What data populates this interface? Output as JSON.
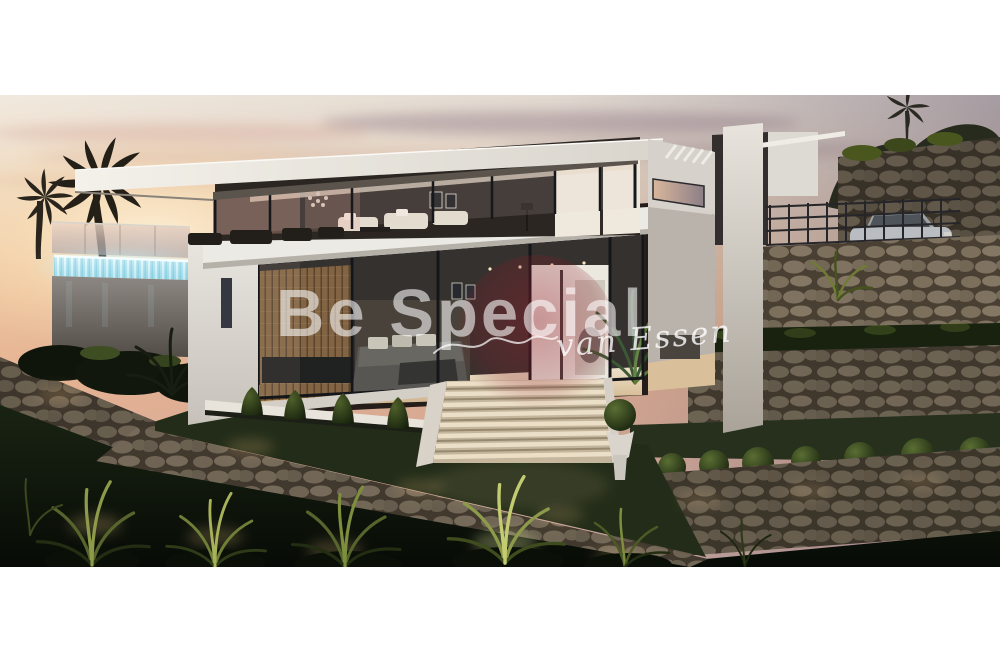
{
  "window": {
    "width": 1000,
    "height": 667,
    "background": "#ffffff"
  },
  "photo": {
    "description": "Architectural render of a modern two-storey white villa at sunset with infinity pool, glowing waterfall edge, glass walls, stone retaining walls, illuminated garden plants and a silver sports car on the upper driveway",
    "area": {
      "left": 0,
      "top": 95,
      "width": 1000,
      "height": 472
    }
  },
  "watermark": {
    "brand": "Be Special",
    "signature": "van Essen",
    "brand_color": "rgba(255,255,255,0.58)",
    "signature_color": "rgba(255,255,255,0.8)",
    "logo_color": "#8a1f2b"
  },
  "palette": {
    "sky_warm": "#ecc49f",
    "sky_mauve": "#8e8190",
    "villa_white": "#e9e6e0",
    "pool_glow": "#c9edf6",
    "stone": "#9a8e79",
    "lawn_dark": "#0b110a",
    "plant_lit": "#8a9a46"
  }
}
